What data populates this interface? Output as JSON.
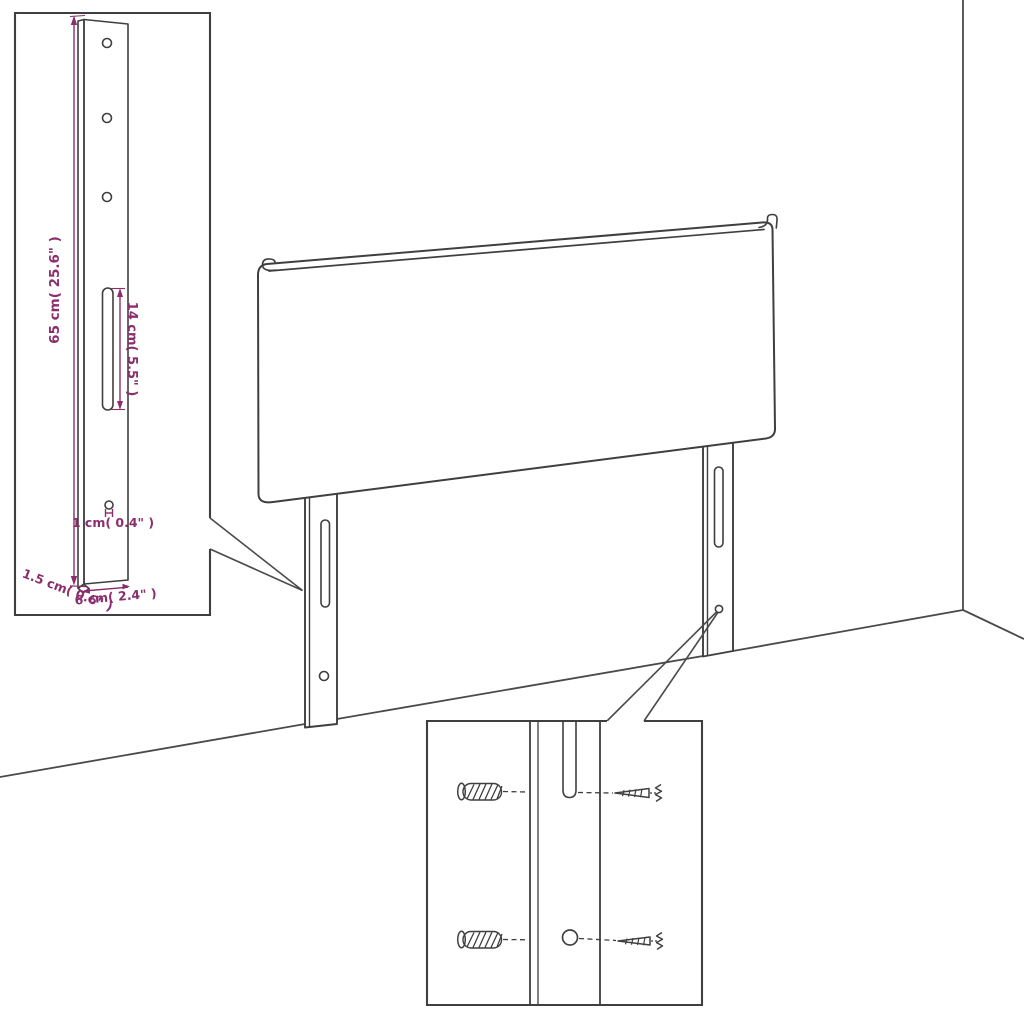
{
  "scene": {
    "description": "Headboard assembly dimension diagram with wall corner, two mounting legs, a magnified leg bracket with dimensions, and a hardware (screws and wall plugs) detail box",
    "background_color": "#ffffff",
    "outline_color": "#3f3f3f",
    "dimension_color": "#8b2e6e"
  },
  "bracket_detail": {
    "height_label": "65 cm( 25.6\" )",
    "slot_label": "14 cm( 5.5\" )",
    "hole_label": "1 cm( 0.4\" )",
    "thickness_label": "1.5 cm( 0.6\" )",
    "width_label": "6 cm( 2.4\" )",
    "screw_holes_count": 3,
    "slot_count": 1,
    "small_hole_count": 1
  },
  "hardware_detail": {
    "wall_plug_count": 2,
    "screw_count": 2,
    "icons": {
      "wall_plug": "hatched-cylinder-anchor",
      "screw": "pointed-shaft-with-spring-head"
    }
  },
  "headboard": {
    "legs_count": 2,
    "slots_per_leg": 1,
    "holes_per_leg": 1
  }
}
